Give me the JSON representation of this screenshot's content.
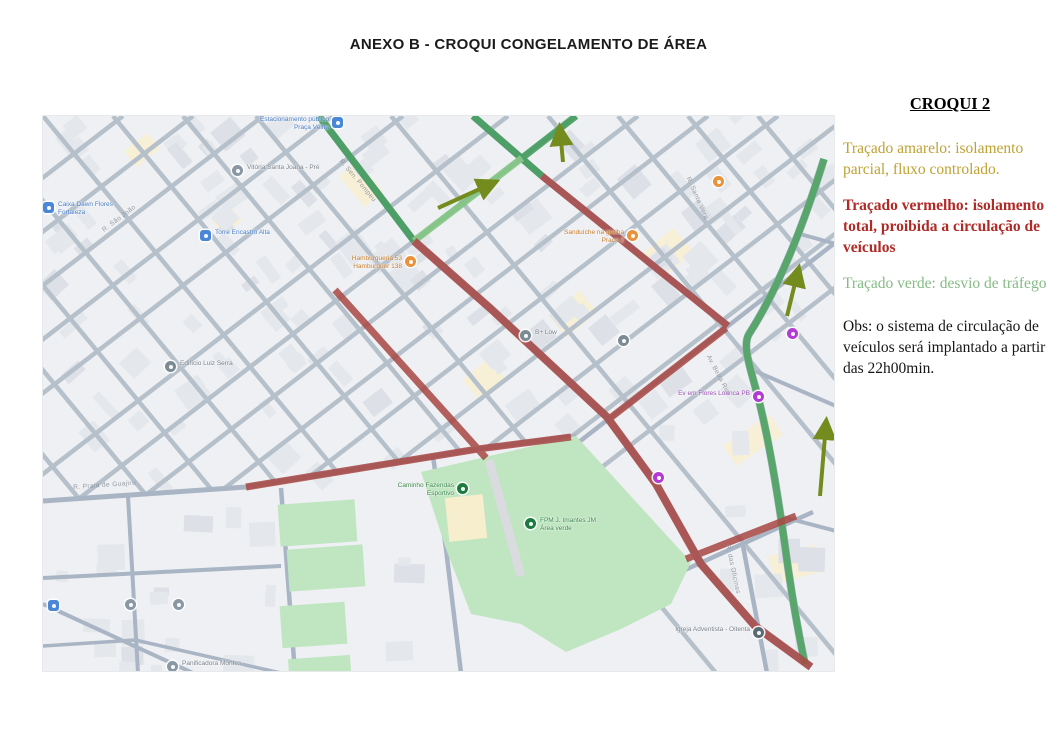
{
  "page": {
    "title": "ANEXO B - CROQUI CONGELAMENTO DE ÁREA"
  },
  "legend": {
    "heading": "CROQUI 2",
    "items": [
      {
        "id": "amarelo",
        "color": "#bfa233",
        "text": "Traçado amarelo: isolamento parcial, fluxo controlado."
      },
      {
        "id": "vermelho",
        "color": "#b02a26",
        "text": "Traçado vermelho: isolamento total, proibida a circulação de veículos"
      },
      {
        "id": "verde",
        "color": "#85bb85",
        "text": "Traçado verde: desvio de tráfego"
      }
    ],
    "obs": "Obs: o sistema de circulação de veículos será implantado a partir das 22h00min."
  },
  "map": {
    "overlay_colors": {
      "red_total_isolation": "#a84743",
      "green_detour": "#4aa35d",
      "green_detour_light": "#7fc57e",
      "arrow_olive": "#748c1e",
      "park_green": "#bfe6c0"
    },
    "pois": [
      {
        "kind": "parking-icon",
        "color": "#4a87d8",
        "shape": "sq",
        "x": 295,
        "y": 7,
        "side": "left",
        "lcolor": "#4a7fc9",
        "lines": [
          "Estacionamento público",
          "Praça Velha"
        ]
      },
      {
        "kind": "place-icon",
        "color": "#8a98a6",
        "shape": "c",
        "x": 195,
        "y": 55,
        "side": "right",
        "lcolor": "#7d848d",
        "lines": [
          "Vitória Santa Joana - Pré"
        ]
      },
      {
        "kind": "bank-icon",
        "color": "#4a87d8",
        "shape": "sq",
        "x": 6,
        "y": 92,
        "side": "right",
        "lcolor": "#4a7fc9",
        "lines": [
          "Caixa Dawn Flores",
          "Fortaleza"
        ]
      },
      {
        "kind": "tower-icon",
        "color": "#4a87d8",
        "shape": "sq",
        "x": 163,
        "y": 120,
        "side": "right",
        "lcolor": "#4a7fc9",
        "lines": [
          "Torre Encastro Alta"
        ]
      },
      {
        "kind": "food-icon",
        "color": "#e8923a",
        "shape": "c",
        "x": 368,
        "y": 146,
        "side": "left",
        "lcolor": "#c77c2e",
        "lines": [
          "Hamburgueria 53",
          "Hamburguer 138"
        ]
      },
      {
        "kind": "food-icon",
        "color": "#e8923a",
        "shape": "c",
        "x": 590,
        "y": 120,
        "side": "left",
        "lcolor": "#c77c2e",
        "lines": [
          "Sanduíche na grelha",
          "Praça 2"
        ]
      },
      {
        "kind": "food-icon",
        "color": "#e8923a",
        "shape": "c",
        "x": 676,
        "y": 66,
        "side": "none",
        "lcolor": "",
        "lines": []
      },
      {
        "kind": "place-icon",
        "color": "#7b8a93",
        "shape": "c",
        "x": 483,
        "y": 220,
        "side": "right",
        "lcolor": "#7d848d",
        "lines": [
          "B+ Low"
        ]
      },
      {
        "kind": "place-icon",
        "color": "#7b8a93",
        "shape": "c",
        "x": 581,
        "y": 225,
        "side": "none",
        "lcolor": "",
        "lines": []
      },
      {
        "kind": "building-icon",
        "color": "#7b8a93",
        "shape": "c",
        "x": 128,
        "y": 251,
        "side": "right",
        "lcolor": "#7d848d",
        "lines": [
          "Edifício Luiz Serra"
        ]
      },
      {
        "kind": "shop-icon",
        "color": "#b13bd4",
        "shape": "c",
        "x": 750,
        "y": 218,
        "side": "none",
        "lcolor": "",
        "lines": []
      },
      {
        "kind": "shop-icon",
        "color": "#b13bd4",
        "shape": "c",
        "x": 716,
        "y": 281,
        "side": "left",
        "lcolor": "#9b4fb5",
        "lines": [
          "Ev em Flores Loanca PB"
        ]
      },
      {
        "kind": "shop-icon",
        "color": "#b13bd4",
        "shape": "c",
        "x": 616,
        "y": 362,
        "side": "none",
        "lcolor": "",
        "lines": []
      },
      {
        "kind": "park-icon",
        "color": "#1d7a3f",
        "shape": "c",
        "x": 420,
        "y": 373,
        "side": "left",
        "lcolor": "#3d8a4e",
        "lines": [
          "Caminho Fazendas",
          "Esportivo"
        ]
      },
      {
        "kind": "park-icon",
        "color": "#1d7a3f",
        "shape": "c",
        "x": 488,
        "y": 408,
        "side": "right",
        "lcolor": "#3d8a4e",
        "lines": [
          "FPM J. Imantes JM",
          "Área verde"
        ]
      },
      {
        "kind": "church-icon",
        "color": "#5b6b73",
        "shape": "c",
        "x": 716,
        "y": 517,
        "side": "left",
        "lcolor": "#7d848d",
        "lines": [
          "Igreja Adventista - Oitenta"
        ]
      },
      {
        "kind": "place-icon",
        "color": "#8a98a6",
        "shape": "c",
        "x": 88,
        "y": 489,
        "side": "none",
        "lcolor": "",
        "lines": []
      },
      {
        "kind": "place-icon",
        "color": "#8a98a6",
        "shape": "c",
        "x": 136,
        "y": 489,
        "side": "none",
        "lcolor": "",
        "lines": []
      },
      {
        "kind": "place-icon",
        "color": "#4a87d8",
        "shape": "sq",
        "x": 11,
        "y": 490,
        "side": "none",
        "lcolor": "",
        "lines": []
      },
      {
        "kind": "shop-icon",
        "color": "#8a98a6",
        "shape": "c",
        "x": 130,
        "y": 551,
        "side": "right",
        "lcolor": "#7d848d",
        "lines": [
          "Panificadora Montes"
        ]
      }
    ],
    "street_labels": [
      {
        "text": "R. Praia de Guajiru",
        "x": 30,
        "y": 368,
        "rot": -4
      },
      {
        "text": "R. Sen. Pompeu",
        "x": 300,
        "y": 42,
        "rot": 50
      },
      {
        "text": "R. São João",
        "x": 58,
        "y": 112,
        "rot": -37
      },
      {
        "text": "R. Santa Vera",
        "x": 648,
        "y": 60,
        "rot": 66
      },
      {
        "text": "Av. Beira Rio",
        "x": 668,
        "y": 238,
        "rot": 62
      },
      {
        "text": "R. das Oficinas",
        "x": 688,
        "y": 428,
        "rot": 78
      }
    ]
  }
}
